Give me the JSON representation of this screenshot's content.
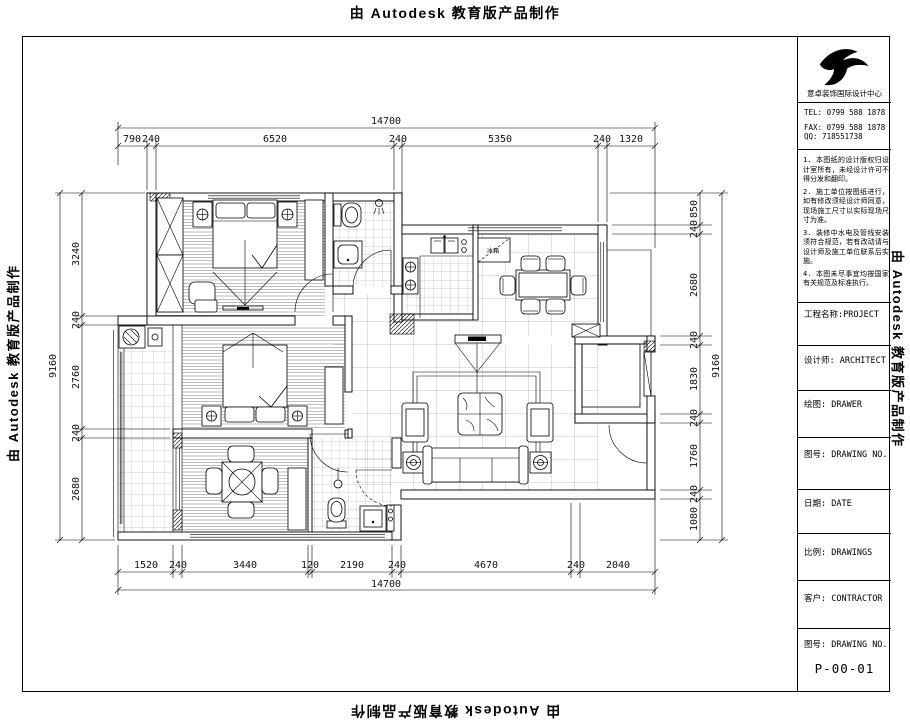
{
  "stamp": {
    "text": "由 Autodesk 教育版产品制作"
  },
  "title_block": {
    "company": "意卓装饰国际设计中心",
    "tel": "TEL: 0799 588 1878",
    "fax": "FAX: 0799 588 1878",
    "qq": "QQ:  718551738",
    "notes": [
      "1. 本图纸的设计版权归设计室所有，未经设计许可不得分发和翻印。",
      "2. 施工单位按图纸进行，如有修改须经设计师同意，现场施工尺寸以实际现场尺寸为准。",
      "3. 装修中水电及管线安装须符合规范，若有改动请与设计师及施工单位联系后实施。",
      "4. 本图未尽事宜均按国家有关规范及标准执行。"
    ],
    "fields": [
      {
        "label": "工程名称:",
        "value": "PROJECT"
      },
      {
        "label": "设计师:",
        "value": "ARCHITECT"
      },
      {
        "label": "绘图:",
        "value": "DRAWER"
      },
      {
        "label": "图号:",
        "value": "DRAWING NO."
      },
      {
        "label": "日期:",
        "value": "DATE"
      },
      {
        "label": "比例:",
        "value": "DRAWINGS"
      },
      {
        "label": "客户:",
        "value": "CONTRACTOR"
      },
      {
        "label": "图号:",
        "value": "DRAWING NO."
      }
    ],
    "drawing_number": "P-00-01"
  },
  "plan": {
    "fridge_label": "冰箱"
  },
  "dimensions": {
    "top": {
      "total": "14700",
      "segments": [
        "790",
        "240",
        "6520",
        "240",
        "5350",
        "240",
        "1320"
      ]
    },
    "bottom": {
      "total": "14700",
      "segments": [
        "1520",
        "240",
        "3440",
        "120",
        "2190",
        "240",
        "4670",
        "240",
        "2040"
      ]
    },
    "left": {
      "total": "9160",
      "segments": [
        "3240",
        "240",
        "2760",
        "240",
        "2680"
      ]
    },
    "right": {
      "total": "9160",
      "segments": [
        "850",
        "240",
        "2680",
        "240",
        "1830",
        "240",
        "1760",
        "240",
        "1080"
      ]
    }
  }
}
